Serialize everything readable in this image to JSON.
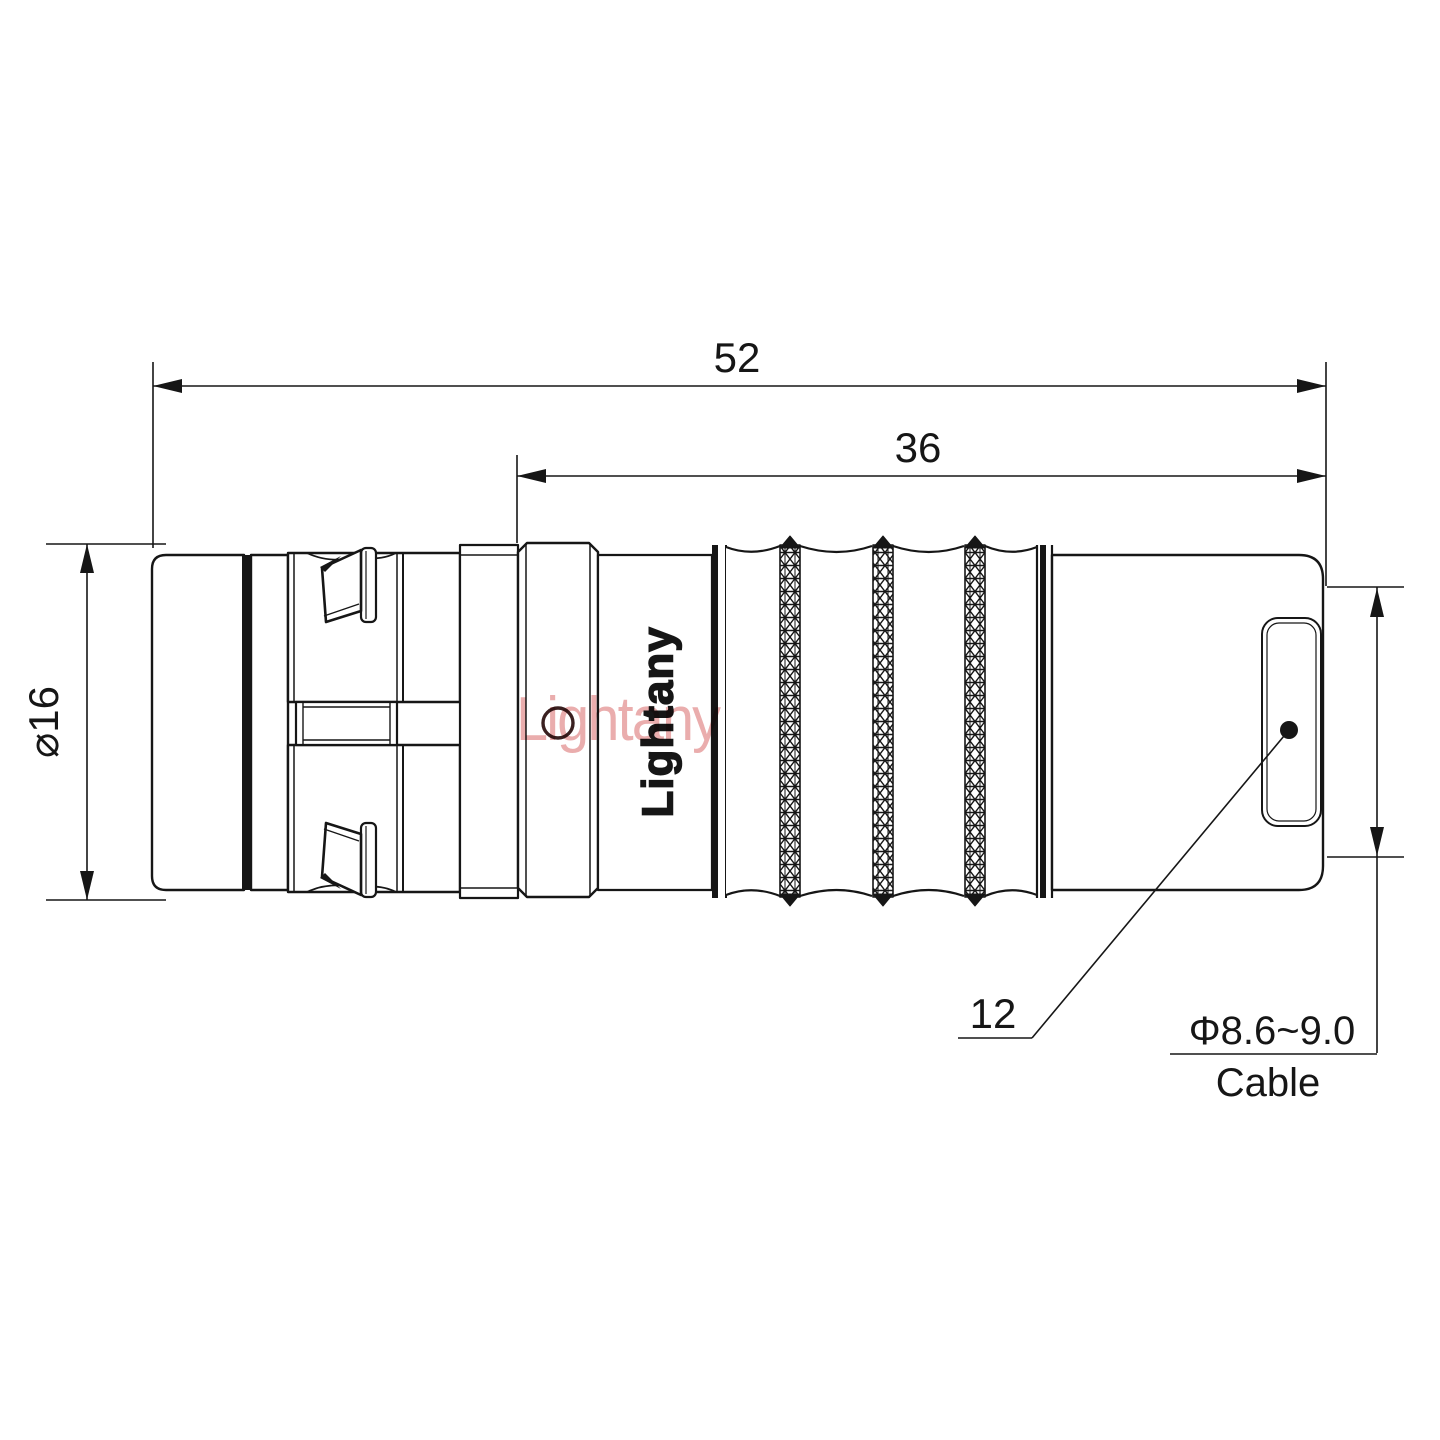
{
  "drawing": {
    "title": "connector-technical-drawing",
    "brand_engraving": "Lightany",
    "watermark": "Lightany",
    "dimensions": {
      "overall_length": "52",
      "rear_length": "36",
      "body_diameter": "⌀16",
      "nut_size": "12",
      "cable_range": "Φ8.6~9.0",
      "cable_label": "Cable"
    },
    "colors": {
      "line": "#161616",
      "background": "#ffffff",
      "watermark": "#d96a6a",
      "hole_accent": "#3a2020"
    }
  }
}
